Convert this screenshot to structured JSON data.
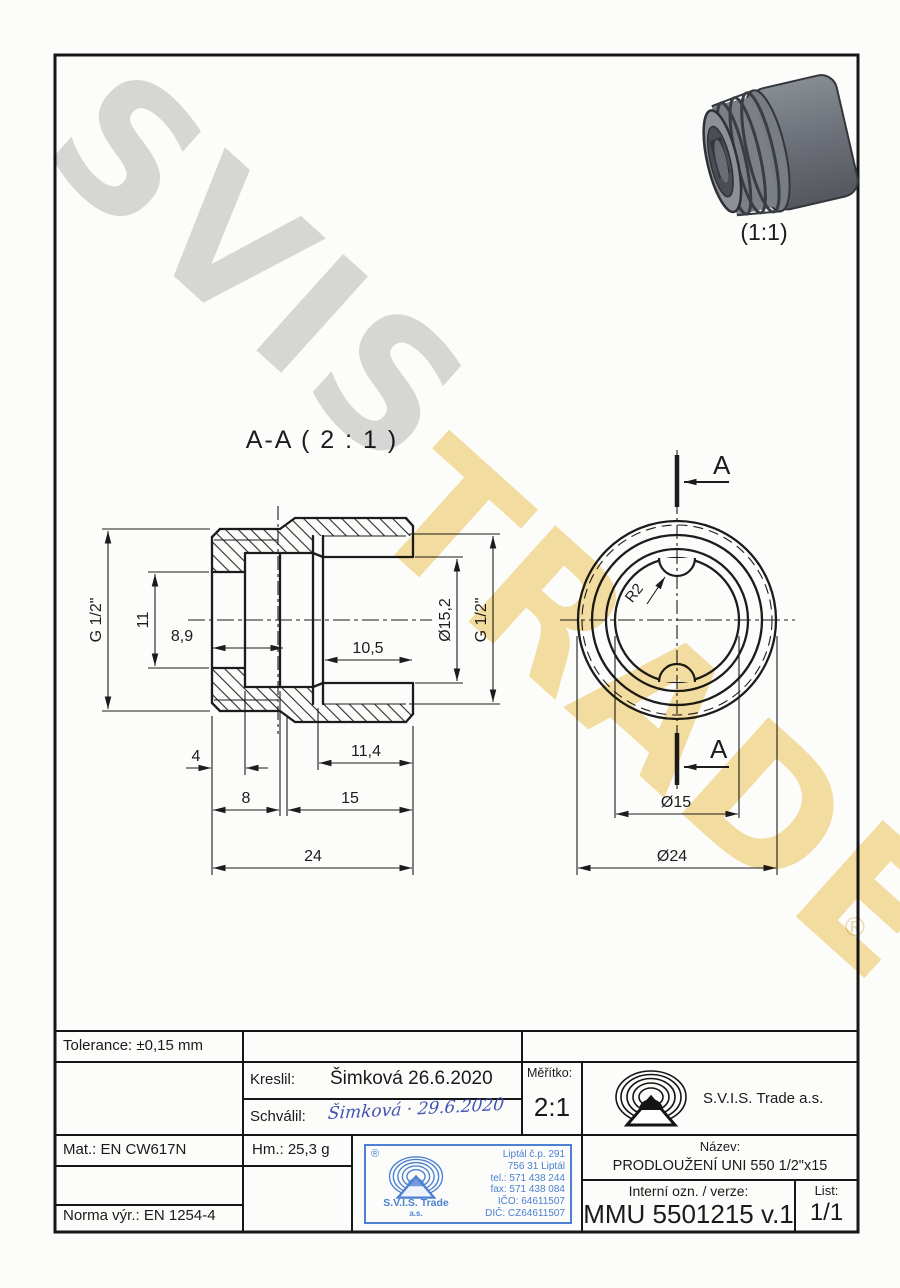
{
  "watermark": {
    "word1": "SVIS",
    "word2": "TRADE",
    "registered": "®",
    "gray": "#d9d9d9",
    "yellow": "#f6dfa2"
  },
  "render3d": {
    "scale_label": "(1:1)"
  },
  "views": {
    "section": {
      "title": "A-A ( 2 : 1 )",
      "dims": {
        "g_left": "G 1/2\"",
        "bore": "11",
        "d89": "8,9",
        "d105": "10,5",
        "d152": "Ø15,2",
        "g_right": "G 1/2\"",
        "d4": "4",
        "d114": "11,4",
        "d8": "8",
        "d15": "15",
        "d24": "24"
      }
    },
    "front": {
      "cut_label": "A",
      "dims": {
        "r2": "R2",
        "d15": "Ø15",
        "d24": "Ø24"
      }
    }
  },
  "title_block": {
    "tolerance": "Tolerance: ±0,15 mm",
    "kreslil_label": "Kreslil:",
    "kreslil_value": "Šimková 26.6.2020",
    "schvalil_label": "Schválil:",
    "schvalil_signature": "Šimková · 29.6.2020",
    "meritko_label": "Měřítko:",
    "meritko_value": "2:1",
    "company": "S.V.I.S. Trade a.s.",
    "mat": "Mat.: EN CW617N",
    "hm": "Hm.: 25,3 g",
    "norma": "Norma výr.: EN 1254-4",
    "nazev_label": "Název:",
    "nazev_value": "PRODLOUŽENÍ UNI 550 1/2\"x15",
    "interni_label": "Interní ozn. / verze:",
    "interni_value": "MMU 5501215 v.1",
    "list_label": "List:",
    "list_value": "1/1",
    "stamp": {
      "registered": "®",
      "company": "S.V.I.S. Trade",
      "company2": "a.s.",
      "line1": "Liptál č.p. 291",
      "line2": "756 31 Liptál",
      "line3": "tel.: 571 438 244",
      "line4": "fax: 571 438 084",
      "line5": "IČO: 64611507",
      "line6": "DIČ: CZ64611507",
      "blue": "#4b80d2"
    }
  }
}
